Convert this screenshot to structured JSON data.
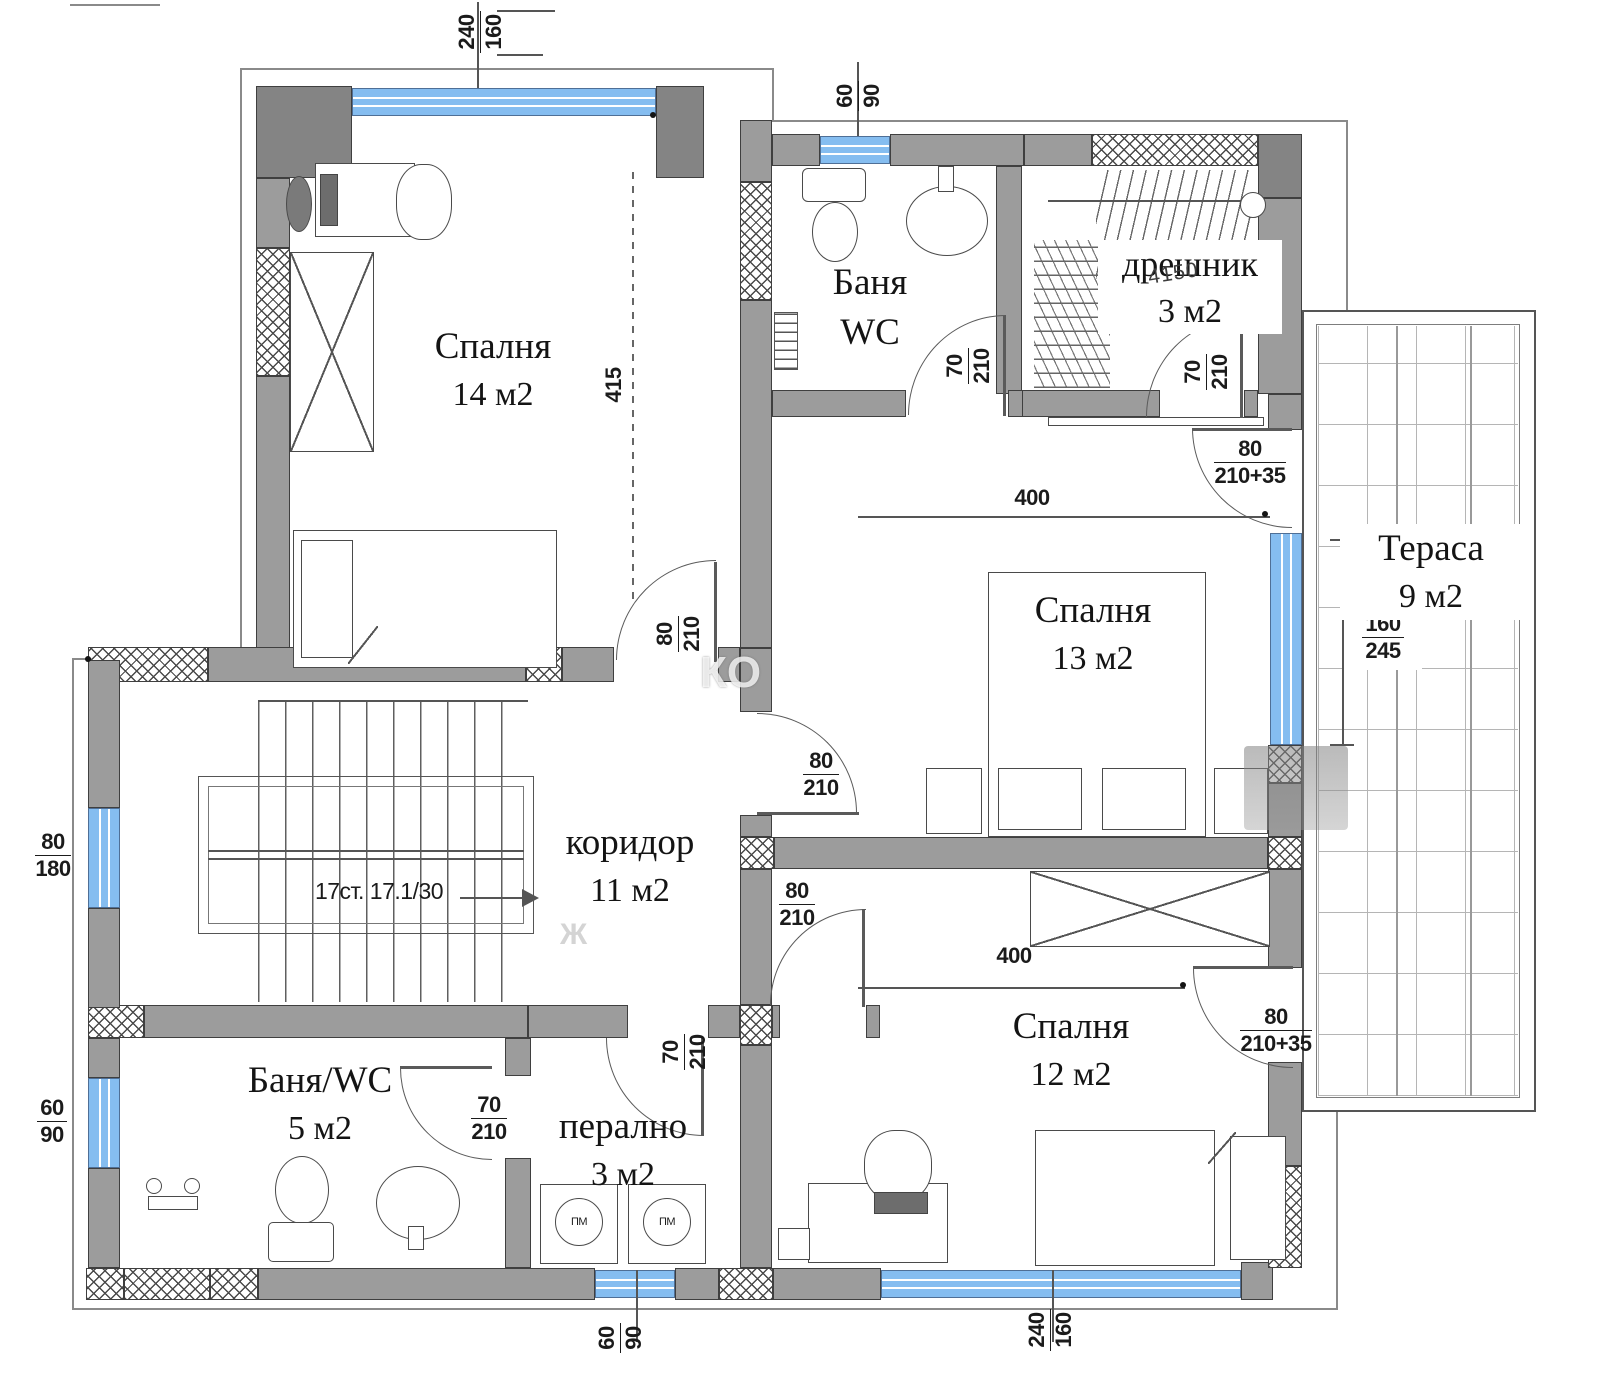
{
  "rooms": {
    "bedroom14": {
      "label": "Спалня",
      "area": "14  м2"
    },
    "bath_top": {
      "line1": "Баня",
      "line2": "WC"
    },
    "closet": {
      "label": "дрешник",
      "area": "3 м2"
    },
    "terrace": {
      "label": "Тераса",
      "area": "9  м2"
    },
    "bedroom13": {
      "label": "Спалня",
      "area": "13  м2"
    },
    "corridor": {
      "label": "коридор",
      "area": "11 м2"
    },
    "bath_bottom": {
      "label": "Баня/WC",
      "area": "5  м2"
    },
    "laundry": {
      "label": "перално",
      "area": "3  м2"
    },
    "bedroom12": {
      "label": "Спалня",
      "area": "12  м2"
    }
  },
  "dims": {
    "win_top": {
      "n": "240",
      "d": "160"
    },
    "win_bath_top": {
      "n": "60",
      "d": "90"
    },
    "height_left": "415",
    "width_hall": "400",
    "width_bedroom12": "400",
    "win_stairs": {
      "n": "80",
      "d": "180"
    },
    "win_bath_left": {
      "n": "60",
      "d": "90"
    },
    "win_terrace": {
      "n": "160",
      "d": "245"
    },
    "win_laundry": {
      "n": "60",
      "d": "90"
    },
    "win_bedroom12": {
      "n": "240",
      "d": "160"
    },
    "door_bedroom14": {
      "n": "80",
      "d": "210"
    },
    "door_bath_top": {
      "n": "70",
      "d": "210"
    },
    "door_closet": {
      "n": "70",
      "d": "210"
    },
    "door_hall_terrace": {
      "n": "80",
      "d": "210+35"
    },
    "door_bedroom13": {
      "n": "80",
      "d": "210"
    },
    "door_bedroom12": {
      "n": "80",
      "d": "210"
    },
    "door_bedroom12_terrace": {
      "n": "80",
      "d": "210+35"
    },
    "door_bath_bottom": {
      "n": "70",
      "d": "210"
    },
    "door_laundry": {
      "n": "70",
      "d": "210"
    }
  },
  "stairs": {
    "label": "17ст. 17.1/30"
  },
  "laundry_machines": {
    "m1": "ПМ",
    "m2": "ПМ"
  },
  "annotations": {
    "closet_note": "4150",
    "watermark1": "КО",
    "watermark2": "Ж"
  },
  "colors": {
    "wall": "#9c9c9c",
    "window_glass": "#85bdf0",
    "outline": "#3f3f3f"
  }
}
